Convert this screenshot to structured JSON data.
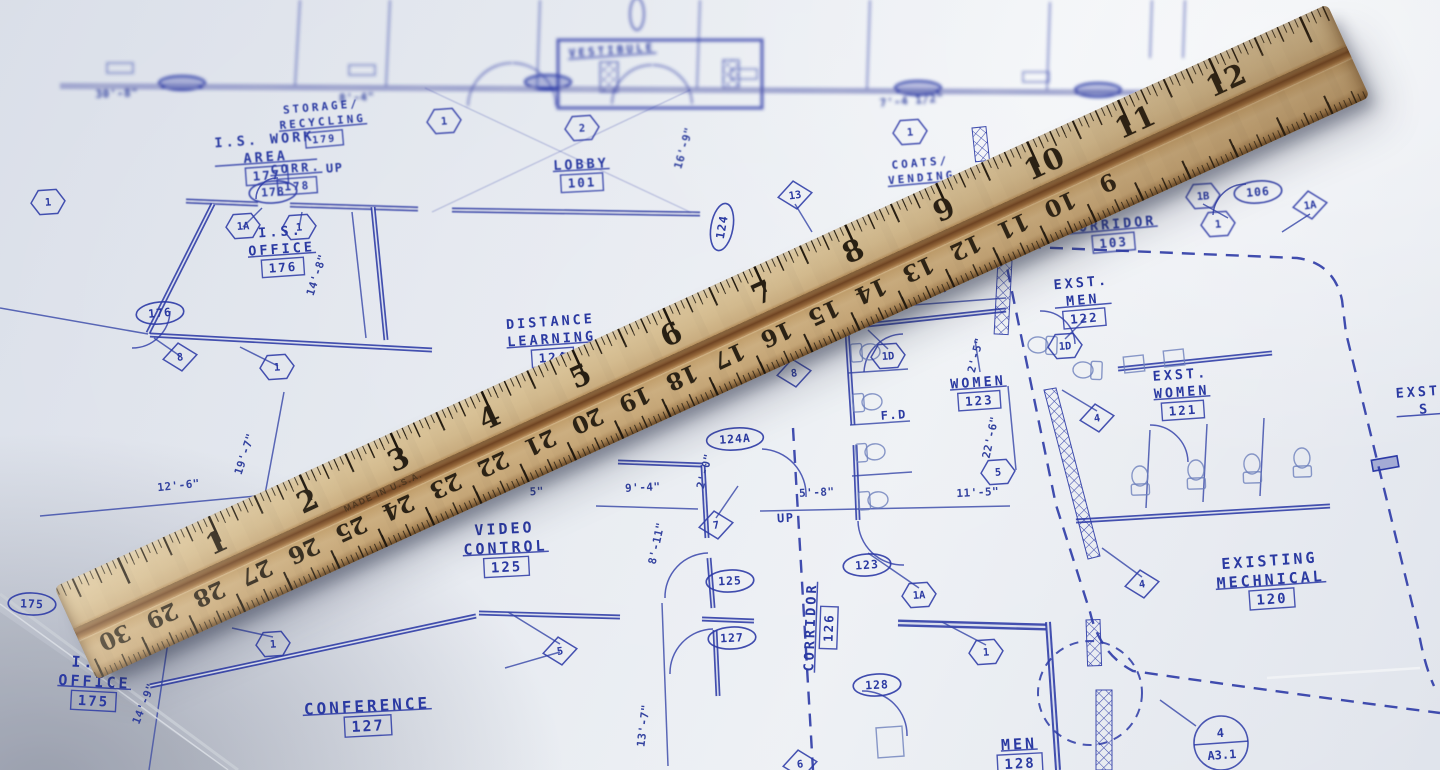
{
  "colors": {
    "paper": "#e6eaf0",
    "ink": "#2b3aa2",
    "ink_soft": "#7487c2",
    "wood": "#d2ba8e",
    "wood_groove": "#8a5f33",
    "shadow": "rgba(40,46,70,0.45)"
  },
  "rooms": [
    {
      "lines": [
        "I.S. WORK",
        "AREA"
      ],
      "num": "177",
      "x": 265,
      "y": 148,
      "rot": -4,
      "g": "mid"
    },
    {
      "lines": [
        "STORAGE/",
        "RECYCLING"
      ],
      "num": "179",
      "x": 322,
      "y": 114,
      "rot": -5,
      "g": "mid",
      "fs": 11
    },
    {
      "lines": [
        "CORR."
      ],
      "num": "178",
      "x": 296,
      "y": 168,
      "rot": -4,
      "g": "mid",
      "fs": 12
    },
    {
      "lines": [
        "I.S.",
        "OFFICE"
      ],
      "num": "176",
      "x": 281,
      "y": 240,
      "rot": -4,
      "g": "main"
    },
    {
      "lines": [
        "LOBBY"
      ],
      "num": "101",
      "x": 581,
      "y": 164,
      "rot": -3,
      "g": "mid"
    },
    {
      "lines": [
        "VESTIBULE"
      ],
      "num": "",
      "x": 612,
      "y": 50,
      "rot": -4,
      "g": "far",
      "fs": 11
    },
    {
      "lines": [
        "DISTANCE",
        "LEARNING"
      ],
      "num": "124",
      "x": 551,
      "y": 330,
      "rot": -4,
      "g": "main"
    },
    {
      "lines": [
        "VIDEO",
        "CONTROL"
      ],
      "num": "125",
      "x": 505,
      "y": 538,
      "rot": -3,
      "g": "main",
      "fs": 15
    },
    {
      "lines": [
        "CONFERENCE"
      ],
      "num": "127",
      "x": 367,
      "y": 706,
      "rot": -3,
      "g": "main",
      "fs": 16
    },
    {
      "lines": [
        "I.S.",
        "OFFICE"
      ],
      "num": "175",
      "x": 95,
      "y": 672,
      "rot": 3,
      "g": "main",
      "fs": 15
    },
    {
      "lines": [
        "WOMEN"
      ],
      "num": "123",
      "x": 978,
      "y": 382,
      "rot": -4,
      "g": "main"
    },
    {
      "lines": [
        "EXST.",
        "MEN"
      ],
      "num": "122",
      "x": 1082,
      "y": 291,
      "rot": -5,
      "g": "main"
    },
    {
      "lines": [
        "EXST.",
        "WOMEN"
      ],
      "num": "121",
      "x": 1181,
      "y": 383,
      "rot": -4,
      "g": "main"
    },
    {
      "lines": [
        "EXISTING",
        "MECHNICAL"
      ],
      "num": "120",
      "x": 1270,
      "y": 570,
      "rot": -4,
      "g": "main",
      "fs": 15
    },
    {
      "lines": [
        "CORRIDOR"
      ],
      "num": "103",
      "x": 1112,
      "y": 224,
      "rot": -5,
      "g": "mid"
    },
    {
      "lines": [
        "COATS/",
        "VENDING"
      ],
      "num": "",
      "x": 921,
      "y": 170,
      "rot": -5,
      "g": "mid",
      "fs": 11
    },
    {
      "lines": [
        "CORRIDOR"
      ],
      "num": "126",
      "x": 810,
      "y": 627,
      "rot": -88,
      "g": "main"
    },
    {
      "lines": [
        "MEN"
      ],
      "num": "128",
      "x": 1019,
      "y": 744,
      "rot": -3,
      "g": "main",
      "fs": 15
    },
    {
      "lines": [
        "EXST.",
        "S"
      ],
      "num": "",
      "x": 1424,
      "y": 400,
      "rot": -4,
      "g": "main"
    }
  ],
  "door_tags": [
    {
      "t": "175",
      "x": 32,
      "y": 604,
      "rot": 2
    },
    {
      "t": "176",
      "x": 160,
      "y": 313,
      "rot": -5
    },
    {
      "t": "178",
      "x": 273,
      "y": 192,
      "rot": -4,
      "g": "mid"
    },
    {
      "t": "124",
      "x": 722,
      "y": 227,
      "rot": -80
    },
    {
      "t": "124A",
      "x": 735,
      "y": 439,
      "rot": -4
    },
    {
      "t": "125",
      "x": 730,
      "y": 581,
      "rot": -3
    },
    {
      "t": "127",
      "x": 732,
      "y": 638,
      "rot": -3
    },
    {
      "t": "123",
      "x": 867,
      "y": 565,
      "rot": -4
    },
    {
      "t": "128",
      "x": 877,
      "y": 685,
      "rot": -3
    },
    {
      "t": "106",
      "x": 1258,
      "y": 192,
      "rot": -5,
      "g": "mid"
    }
  ],
  "hex_tags": [
    {
      "t": "1A",
      "x": 243,
      "y": 226
    },
    {
      "t": "1",
      "x": 299,
      "y": 227
    },
    {
      "t": "1",
      "x": 48,
      "y": 202
    },
    {
      "t": "2",
      "x": 582,
      "y": 128,
      "g": "mid"
    },
    {
      "t": "1",
      "x": 444,
      "y": 121,
      "g": "mid"
    },
    {
      "t": "1",
      "x": 277,
      "y": 367
    },
    {
      "t": "1",
      "x": 910,
      "y": 132,
      "g": "mid"
    },
    {
      "t": "1B",
      "x": 1203,
      "y": 196,
      "g": "mid"
    },
    {
      "t": "1",
      "x": 1218,
      "y": 224,
      "g": "mid"
    },
    {
      "t": "1D",
      "x": 888,
      "y": 356
    },
    {
      "t": "1D",
      "x": 1065,
      "y": 346
    },
    {
      "t": "5",
      "x": 998,
      "y": 472
    },
    {
      "t": "1A",
      "x": 919,
      "y": 595
    },
    {
      "t": "1",
      "x": 986,
      "y": 652
    },
    {
      "t": "1",
      "x": 273,
      "y": 644
    }
  ],
  "diamond_tags": [
    {
      "t": "8",
      "x": 180,
      "y": 357
    },
    {
      "t": "13",
      "x": 795,
      "y": 195
    },
    {
      "t": "1A",
      "x": 1310,
      "y": 205,
      "g": "mid"
    },
    {
      "t": "4",
      "x": 1097,
      "y": 418
    },
    {
      "t": "4",
      "x": 1142,
      "y": 584
    },
    {
      "t": "5",
      "x": 560,
      "y": 651
    },
    {
      "t": "7",
      "x": 716,
      "y": 525
    },
    {
      "t": "8",
      "x": 794,
      "y": 373
    },
    {
      "t": "6",
      "x": 800,
      "y": 764
    }
  ],
  "dimensions": [
    {
      "t": "30'-8\"",
      "x": 117,
      "y": 97,
      "rot": -2,
      "g": "far"
    },
    {
      "t": "8'-4\"",
      "x": 357,
      "y": 101,
      "rot": -3,
      "g": "far"
    },
    {
      "t": "7'-4 1/2\"",
      "x": 912,
      "y": 104,
      "rot": -5,
      "g": "far"
    },
    {
      "t": "14'-8\"",
      "x": 320,
      "y": 276,
      "rot": -72
    },
    {
      "t": "19'-7\"",
      "x": 248,
      "y": 455,
      "rot": -72
    },
    {
      "t": "12'-6\"",
      "x": 179,
      "y": 489,
      "rot": -6
    },
    {
      "t": "14'-9\"",
      "x": 147,
      "y": 705,
      "rot": -68
    },
    {
      "t": "9'-4\"",
      "x": 643,
      "y": 491,
      "rot": -3
    },
    {
      "t": "5\"",
      "x": 537,
      "y": 495,
      "rot": -3
    },
    {
      "t": "2'-0\"",
      "x": 708,
      "y": 472,
      "rot": -76
    },
    {
      "t": "8'-11\"",
      "x": 660,
      "y": 544,
      "rot": -78
    },
    {
      "t": "5'-8\"",
      "x": 817,
      "y": 496,
      "rot": -3
    },
    {
      "t": "11'-5\"",
      "x": 978,
      "y": 496,
      "rot": -3
    },
    {
      "t": "22'-6\"",
      "x": 994,
      "y": 438,
      "rot": -78
    },
    {
      "t": "10'-0\"",
      "x": 934,
      "y": 293,
      "rot": -5
    },
    {
      "t": "2'-5\"",
      "x": 979,
      "y": 356,
      "rot": -76
    },
    {
      "t": "13'-7\"",
      "x": 647,
      "y": 726,
      "rot": -83
    },
    {
      "t": "16'-9\"",
      "x": 687,
      "y": 149,
      "rot": -74,
      "g": "mid"
    }
  ],
  "labels": [
    {
      "t": "UP",
      "x": 335,
      "y": 172,
      "rot": -4,
      "g": "mid"
    },
    {
      "t": "UP",
      "x": 786,
      "y": 522,
      "rot": -3
    },
    {
      "t": "F.D",
      "x": 894,
      "y": 419,
      "rot": -4
    }
  ],
  "callout": {
    "top": "4",
    "bottom": "A3.1",
    "x": 1221,
    "y": 743
  },
  "ruler": {
    "inch_numbers": [
      "1",
      "2",
      "3",
      "4",
      "5",
      "6",
      "7",
      "8",
      "9",
      "10",
      "11",
      "12"
    ],
    "cm_numbers": [
      "30",
      "29",
      "28",
      "27",
      "26",
      "25",
      "24",
      "23",
      "22",
      "21",
      "20",
      "19",
      "18",
      "17",
      "16",
      "15",
      "14",
      "13",
      "12",
      "11",
      "10",
      "9"
    ],
    "made_in": "MADE IN U.S.A."
  }
}
